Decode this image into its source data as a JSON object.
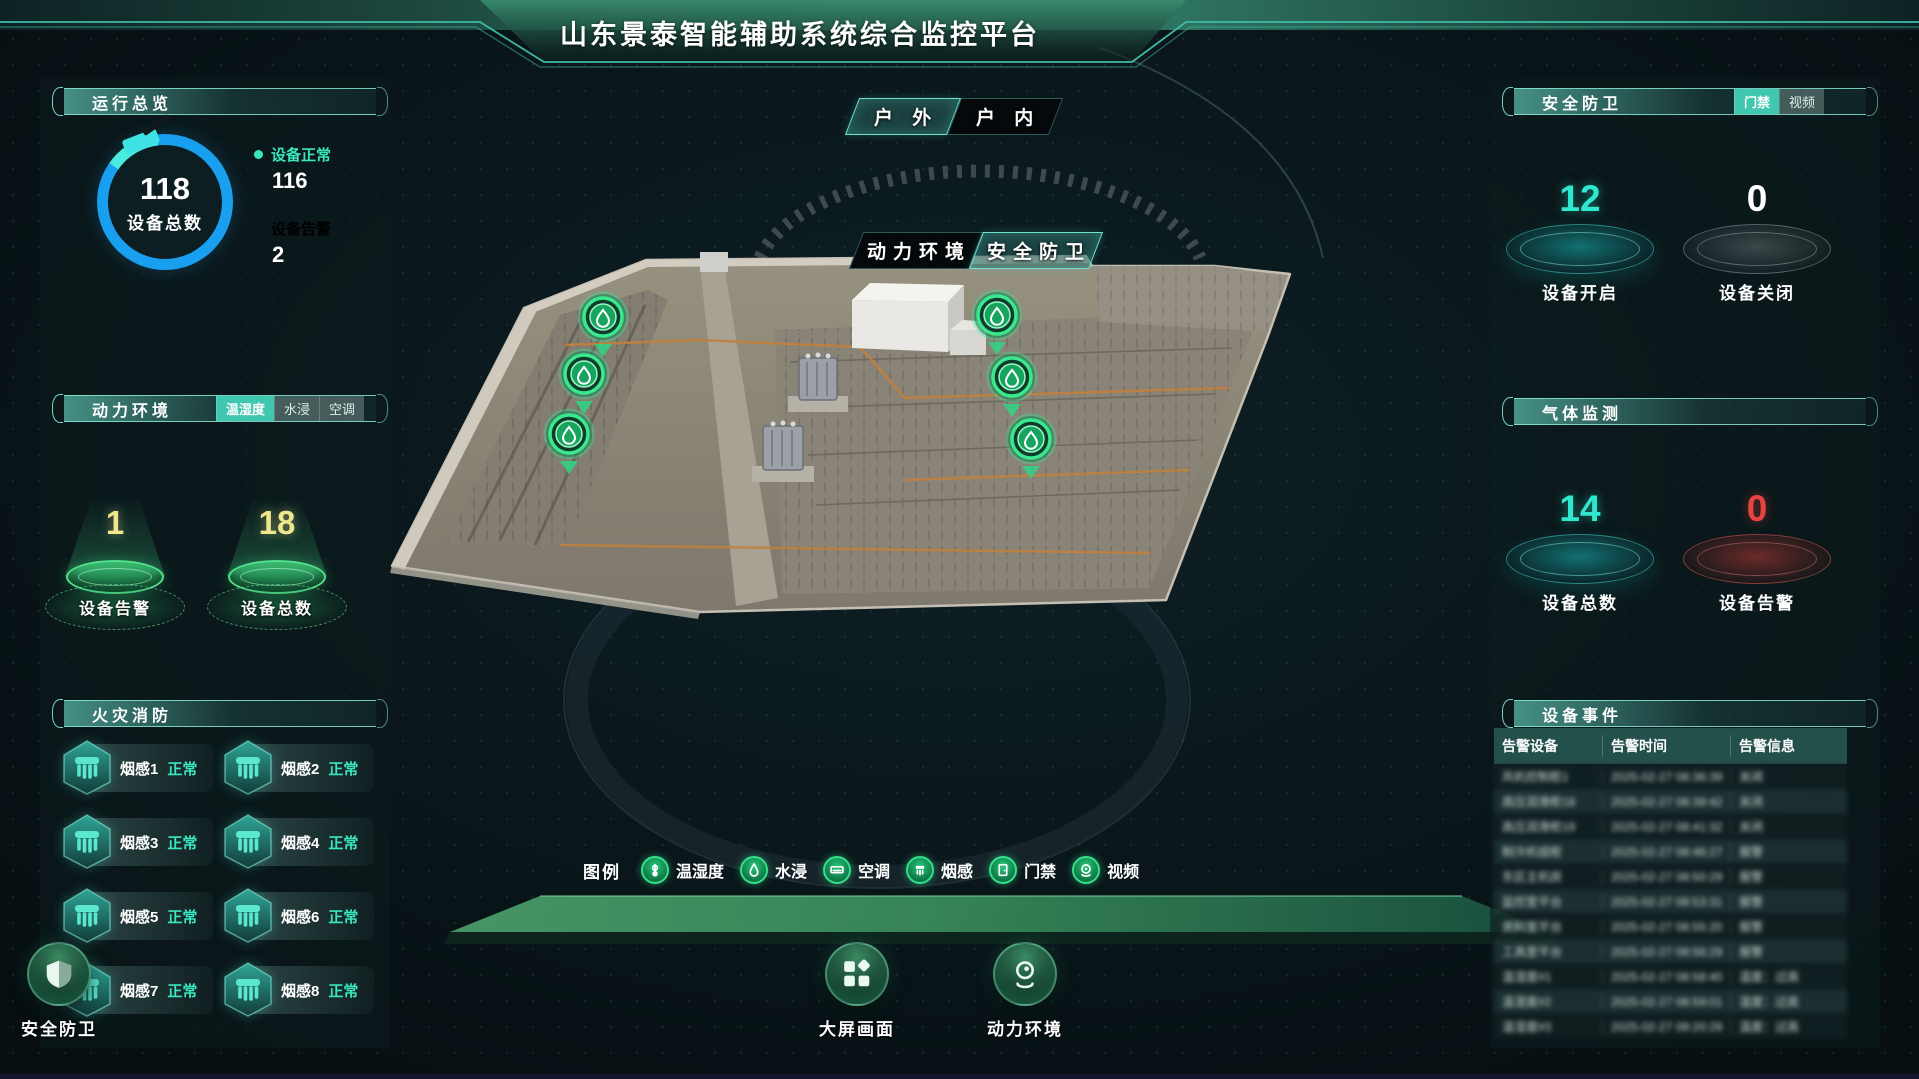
{
  "title": "山东景泰智能辅助系统综合监控平台",
  "colors": {
    "accent_teal": "#3fc7b0",
    "blue": "#189ff0",
    "alarm_red": "#e84343",
    "num_yellow": "#efe78c",
    "green_marker": "#3ae98e"
  },
  "view_tabs": [
    {
      "label": "户 外",
      "active": true
    },
    {
      "label": "户 内",
      "active": false
    }
  ],
  "scene_tabs": [
    {
      "label": "动力环境",
      "active": false
    },
    {
      "label": "安全防卫",
      "active": true
    }
  ],
  "overview": {
    "header": "运行总览",
    "gauge_value": "118",
    "gauge_label": "设备总数",
    "stats": [
      {
        "label": "设备正常",
        "value": "116"
      },
      {
        "label": "设备告警",
        "value": "2"
      }
    ]
  },
  "power_env": {
    "header": "动力环境",
    "tabs": [
      {
        "label": "温湿度",
        "active": true
      },
      {
        "label": "水浸",
        "active": false
      },
      {
        "label": "空调",
        "active": false
      }
    ],
    "pedestals": [
      {
        "value": "18",
        "label": "设备总数"
      },
      {
        "value": "1",
        "label": "设备告警"
      }
    ]
  },
  "fire": {
    "header": "火灾消防",
    "items": [
      {
        "name": "烟感1",
        "status": "正常"
      },
      {
        "name": "烟感2",
        "status": "正常"
      },
      {
        "name": "烟感3",
        "status": "正常"
      },
      {
        "name": "烟感4",
        "status": "正常"
      },
      {
        "name": "烟感5",
        "status": "正常"
      },
      {
        "name": "烟感6",
        "status": "正常"
      },
      {
        "name": "烟感7",
        "status": "正常"
      },
      {
        "name": "烟感8",
        "status": "正常"
      }
    ]
  },
  "security": {
    "header": "安全防卫",
    "tabs": [
      {
        "label": "门禁",
        "active": true
      },
      {
        "label": "视频",
        "active": false
      }
    ],
    "discs": [
      {
        "value": "12",
        "label": "设备开启",
        "type": "teal"
      },
      {
        "value": "0",
        "label": "设备关闭",
        "type": "gray"
      }
    ]
  },
  "gas": {
    "header": "气体监测",
    "discs": [
      {
        "value": "14",
        "label": "设备总数",
        "type": "teal"
      },
      {
        "value": "0",
        "label": "设备告警",
        "type": "red"
      }
    ]
  },
  "events": {
    "header": "设备事件",
    "columns": [
      "告警设备",
      "告警时间",
      "告警信息"
    ],
    "rows": [
      [
        "风机控制柜1",
        "2025-02-27 08:36:39",
        "关闭"
      ],
      [
        "高压润滑柜18",
        "2025-02-27 08:39:42",
        "关闭"
      ],
      [
        "高压润滑柜19",
        "2025-02-27 08:41:32",
        "关闭"
      ],
      [
        "制冷机组柜",
        "2025-02-27 08:46:27",
        "报警"
      ],
      [
        "东区主机房",
        "2025-02-27 08:50:29",
        "报警"
      ],
      [
        "监控室平台",
        "2025-02-27 08:53:31",
        "报警"
      ],
      [
        "资料室平台",
        "2025-02-27 08:55:20",
        "报警"
      ],
      [
        "工具室平台",
        "2025-02-27 08:56:29",
        "报警"
      ],
      [
        "温湿度#1",
        "2025-02-27 08:58:40",
        "温度：过高"
      ],
      [
        "温湿度#2",
        "2025-02-27 08:59:01",
        "温度：过高"
      ],
      [
        "温湿度#3",
        "2025-02-27 09:20:29",
        "温度：过高"
      ]
    ]
  },
  "legend": {
    "label": "图例",
    "items": [
      {
        "icon": "thermometer",
        "label": "温湿度"
      },
      {
        "icon": "drop",
        "label": "水浸"
      },
      {
        "icon": "ac",
        "label": "空调"
      },
      {
        "icon": "smoke",
        "label": "烟感"
      },
      {
        "icon": "door",
        "label": "门禁"
      },
      {
        "icon": "camera",
        "label": "视频"
      }
    ]
  },
  "nav_buttons": [
    {
      "icon": "screen",
      "label": "大屏画面"
    },
    {
      "icon": "webcam",
      "label": "动力环境"
    },
    {
      "icon": "shield",
      "label": "安全防卫"
    }
  ],
  "scene": {
    "markers": [
      {
        "x": 603,
        "y": 317
      },
      {
        "x": 584,
        "y": 374
      },
      {
        "x": 569,
        "y": 434
      },
      {
        "x": 997,
        "y": 315
      },
      {
        "x": 1012,
        "y": 377
      },
      {
        "x": 1031,
        "y": 439
      }
    ]
  }
}
